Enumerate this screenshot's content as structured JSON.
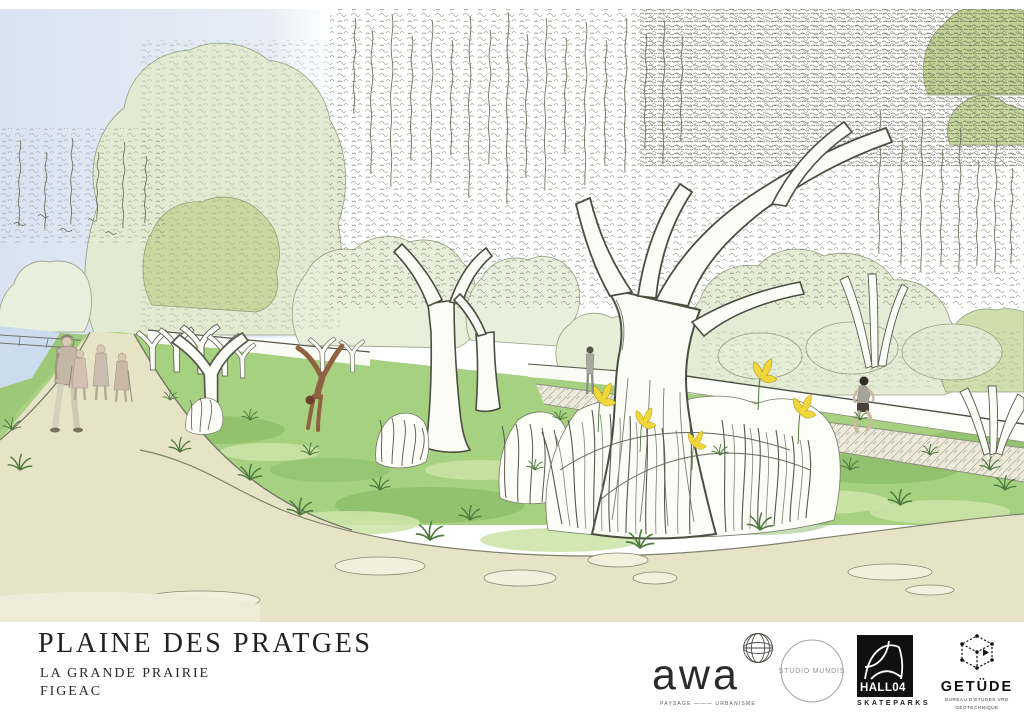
{
  "board": {
    "title": "PLAINE DES PRATGES",
    "subtitle": "LA GRANDE PRAIRIE",
    "location": "FIGEAC"
  },
  "partners": {
    "awa": {
      "wordmark": "awa",
      "tagline": "PAYSAGE ——— URBANISME",
      "emblem_icon": "globe-icon"
    },
    "studio_mundis": {
      "label": "STUDIO MUNDIS",
      "emblem_icon": "circle-outline-icon"
    },
    "hall04": {
      "wordmark": "HALL04",
      "label": "SKATEPARKS",
      "emblem_icon": "skate-ramp-icon"
    },
    "getude": {
      "wordmark": "GETÜDE",
      "line1": "BUREAU D'ÉTUDES VRD",
      "line2": "GÉOTECHNIQUE",
      "emblem_icon": "wireframe-cube-icon"
    }
  },
  "illustration": {
    "palette": {
      "sky_blue": "#d9e3f1",
      "foliage_pale": "#e3ecd2",
      "foliage_mid": "#c8d89e",
      "lawn_green": "#a6d180",
      "ground_beige": "#e7e3c6",
      "water_blue": "#ccdbed",
      "ink_line": "#54584a",
      "flower_yellow": "#f0d83a",
      "figure_sepia": "#8f6242"
    }
  }
}
